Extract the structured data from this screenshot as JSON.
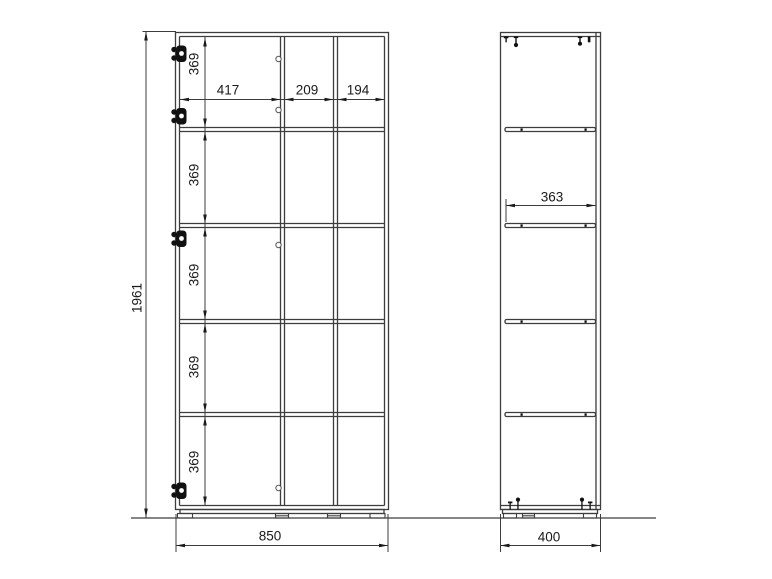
{
  "drawing": {
    "front_view": {
      "overall_height_mm": "1961",
      "overall_width_mm": "850",
      "column_widths_mm": [
        "417",
        "209",
        "194"
      ],
      "row_heights_mm": [
        "369",
        "369",
        "369",
        "369",
        "369"
      ]
    },
    "side_view": {
      "overall_depth_mm": "400",
      "shelf_depth_mm": "363"
    },
    "icons": {
      "hinge_icon": "black cup-hinge silhouette on left door edge",
      "hole_icon": "small round fitting hole on center divider",
      "shelf_pin_icon": "small dot under shelf in side view",
      "mounting_bolt_icon": "bolt pin with ball end at top and bottom",
      "foot_icon": "small rectangular glide foot under plinth"
    },
    "colors": {
      "line": "#3d3d3d",
      "text": "#1a1a1a",
      "background": "#ffffff"
    }
  }
}
